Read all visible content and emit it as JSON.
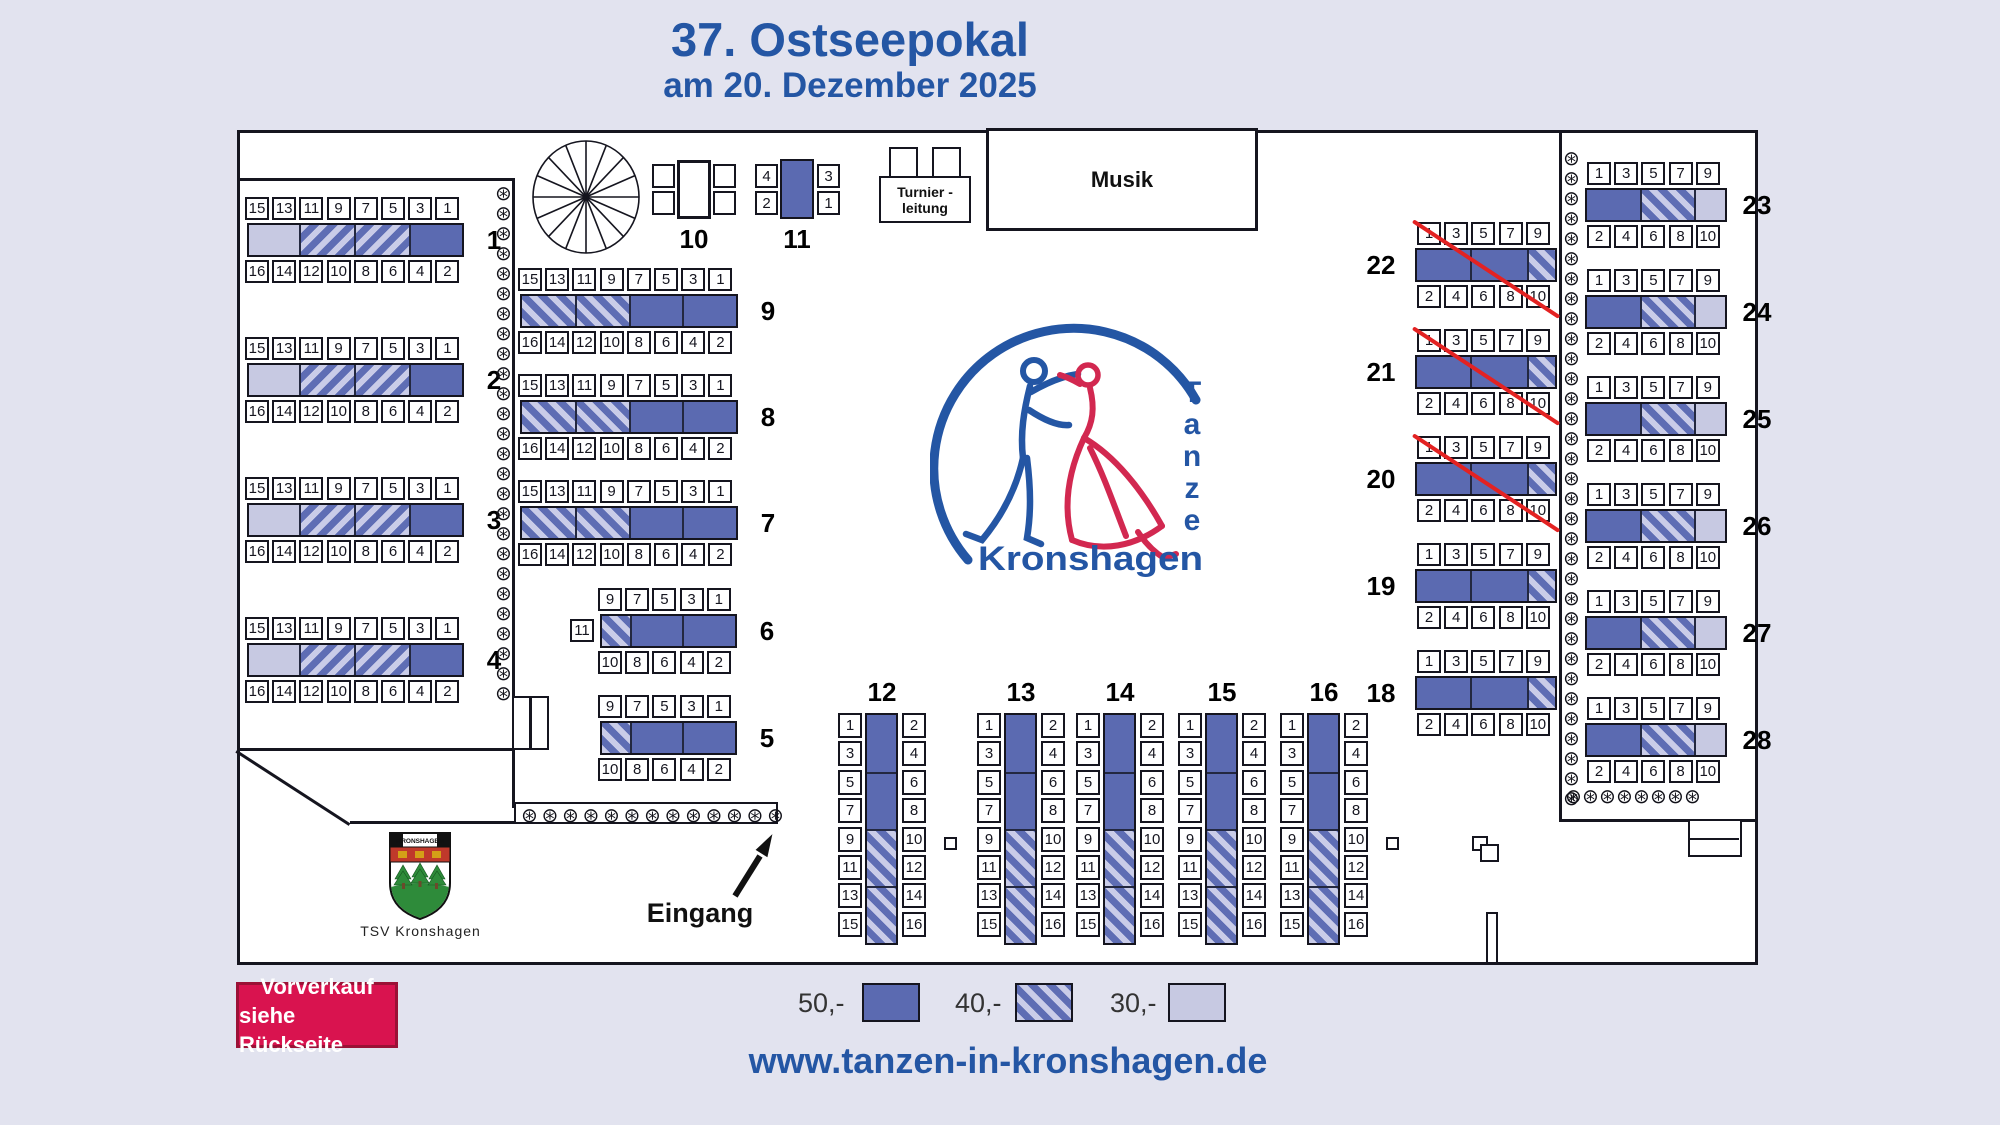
{
  "title": {
    "line1": "37. Ostseepokal",
    "line2": "am 20. Dezember 2025"
  },
  "footer": {
    "url": "www.tanzen-in-kronshagen.de"
  },
  "presale": {
    "line1": "Vorverkauf",
    "line2": "siehe Rückseite"
  },
  "legend": {
    "items": [
      {
        "price": "50,-",
        "cls": "p50"
      },
      {
        "price": "40,-",
        "cls": "h40b"
      },
      {
        "price": "30,-",
        "cls": "p30"
      }
    ]
  },
  "areas": {
    "musik": "Musik",
    "turnier_line1": "Turnier -",
    "turnier_line2": "leitung",
    "eingang": "Eingang",
    "tsv_caption": "TSV Kronshagen"
  },
  "logo": {
    "v": [
      "T",
      "a",
      "n",
      "z",
      "e"
    ],
    "bottom": "Kronshagen",
    "crest_title": "KRONSHAGEN"
  },
  "colors": {
    "accent_blue": "#2456a4",
    "price50": "#5b6ab1",
    "price40_stripe": "#5e6db4",
    "price40_bg": "#c9cce8",
    "price30": "#c7c9e2",
    "badge": "#d9134f",
    "cross_red": "#e32222",
    "page_bg": "#e2e3ef"
  },
  "flower_glyph": "⊛",
  "flower_runs": [
    {
      "name": "plant-column-left",
      "x": 495,
      "y": 183,
      "dx": 0,
      "dy": 20,
      "n": 26
    },
    {
      "name": "plant-column-right",
      "x": 1563,
      "y": 148,
      "dx": 0,
      "dy": 20,
      "n": 33
    },
    {
      "name": "plant-row-bottom-right",
      "x": 1565,
      "y": 786,
      "dx": 17,
      "dy": 0,
      "n": 8
    },
    {
      "name": "plant-box-row",
      "x": 521,
      "y": 805,
      "dx": 20.5,
      "dy": 0,
      "n": 13
    }
  ],
  "seat_sets": {
    "w8_top": [
      "15",
      "13",
      "11",
      "9",
      "7",
      "5",
      "3",
      "1"
    ],
    "w8_bot": [
      "16",
      "14",
      "12",
      "10",
      "8",
      "6",
      "4",
      "2"
    ],
    "w5_top": [
      "9",
      "7",
      "5",
      "3",
      "1"
    ],
    "w5_bot": [
      "10",
      "8",
      "6",
      "4",
      "2"
    ],
    "e5_top": [
      "1",
      "3",
      "5",
      "7",
      "9"
    ],
    "e5_bot": [
      "2",
      "4",
      "6",
      "8",
      "10"
    ],
    "v_left": [
      "1",
      "3",
      "5",
      "7",
      "9",
      "11",
      "13",
      "15"
    ],
    "v_right": [
      "2",
      "4",
      "6",
      "8",
      "10",
      "12",
      "14",
      "16"
    ]
  },
  "tables": [
    {
      "n": "1",
      "o": "h",
      "x": 245,
      "y": 197,
      "set": "w8",
      "segs": [
        [
          50,
          "p30"
        ],
        [
          55,
          "h40a"
        ],
        [
          55,
          "h40a"
        ],
        [
          53,
          "p50"
        ]
      ],
      "side": "right"
    },
    {
      "n": "2",
      "o": "h",
      "x": 245,
      "y": 337,
      "set": "w8",
      "segs": [
        [
          50,
          "p30"
        ],
        [
          55,
          "h40a"
        ],
        [
          55,
          "h40a"
        ],
        [
          53,
          "p50"
        ]
      ],
      "side": "right"
    },
    {
      "n": "3",
      "o": "h",
      "x": 245,
      "y": 477,
      "set": "w8",
      "segs": [
        [
          50,
          "p30"
        ],
        [
          55,
          "h40a"
        ],
        [
          55,
          "h40a"
        ],
        [
          53,
          "p50"
        ]
      ],
      "side": "right"
    },
    {
      "n": "4",
      "o": "h",
      "x": 245,
      "y": 617,
      "set": "w8",
      "segs": [
        [
          50,
          "p30"
        ],
        [
          55,
          "h40a"
        ],
        [
          55,
          "h40a"
        ],
        [
          53,
          "p50"
        ]
      ],
      "side": "right"
    },
    {
      "n": "9",
      "o": "h",
      "x": 518,
      "y": 268,
      "set": "w8",
      "segs": [
        [
          53,
          "h40b"
        ],
        [
          54,
          "h40b"
        ],
        [
          53,
          "p50"
        ],
        [
          54,
          "p50"
        ]
      ],
      "side": "right"
    },
    {
      "n": "8",
      "o": "h",
      "x": 518,
      "y": 374,
      "set": "w8",
      "segs": [
        [
          53,
          "h40b"
        ],
        [
          54,
          "h40b"
        ],
        [
          53,
          "p50"
        ],
        [
          54,
          "p50"
        ]
      ],
      "side": "right"
    },
    {
      "n": "7",
      "o": "h",
      "x": 518,
      "y": 480,
      "set": "w8",
      "segs": [
        [
          53,
          "h40b"
        ],
        [
          54,
          "h40b"
        ],
        [
          53,
          "p50"
        ],
        [
          54,
          "p50"
        ]
      ],
      "side": "right"
    },
    {
      "n": "6",
      "o": "h",
      "x": 598,
      "y": 588,
      "set": "w5",
      "segs": [
        [
          28,
          "h40b"
        ],
        [
          52,
          "p50"
        ],
        [
          53,
          "p50"
        ]
      ],
      "side": "right",
      "extra": {
        "n": "11",
        "x": 570,
        "y": 619
      }
    },
    {
      "n": "5",
      "o": "h",
      "x": 598,
      "y": 695,
      "set": "w5",
      "segs": [
        [
          28,
          "h40b"
        ],
        [
          52,
          "p50"
        ],
        [
          53,
          "p50"
        ]
      ],
      "side": "right"
    },
    {
      "n": "12",
      "o": "v",
      "x": 838,
      "y": 713,
      "set": "v",
      "segs": [
        [
          57,
          "p50"
        ],
        [
          57,
          "p50"
        ],
        [
          57,
          "h40b"
        ],
        [
          57,
          "h40b"
        ]
      ],
      "side": "top"
    },
    {
      "n": "13",
      "o": "v",
      "x": 977,
      "y": 713,
      "set": "v",
      "segs": [
        [
          57,
          "p50"
        ],
        [
          57,
          "p50"
        ],
        [
          57,
          "h40b"
        ],
        [
          57,
          "h40b"
        ]
      ],
      "side": "top"
    },
    {
      "n": "14",
      "o": "v",
      "x": 1076,
      "y": 713,
      "set": "v",
      "segs": [
        [
          57,
          "p50"
        ],
        [
          57,
          "p50"
        ],
        [
          57,
          "h40b"
        ],
        [
          57,
          "h40b"
        ]
      ],
      "side": "top"
    },
    {
      "n": "15",
      "o": "v",
      "x": 1178,
      "y": 713,
      "set": "v",
      "segs": [
        [
          57,
          "p50"
        ],
        [
          57,
          "p50"
        ],
        [
          57,
          "h40b"
        ],
        [
          57,
          "h40b"
        ]
      ],
      "side": "top"
    },
    {
      "n": "16",
      "o": "v",
      "x": 1280,
      "y": 713,
      "set": "v",
      "segs": [
        [
          57,
          "p50"
        ],
        [
          57,
          "p50"
        ],
        [
          57,
          "h40b"
        ],
        [
          57,
          "h40b"
        ]
      ],
      "side": "top"
    },
    {
      "n": "22",
      "o": "h",
      "x": 1417,
      "y": 222,
      "set": "e5",
      "segs": [
        [
          53,
          "p50"
        ],
        [
          57,
          "p50"
        ],
        [
          28,
          "h40b"
        ]
      ],
      "side": "left",
      "bdx": -2,
      "crossed": true
    },
    {
      "n": "21",
      "o": "h",
      "x": 1417,
      "y": 329,
      "set": "e5",
      "segs": [
        [
          53,
          "p50"
        ],
        [
          57,
          "p50"
        ],
        [
          28,
          "h40b"
        ]
      ],
      "side": "left",
      "bdx": -2,
      "crossed": true
    },
    {
      "n": "20",
      "o": "h",
      "x": 1417,
      "y": 436,
      "set": "e5",
      "segs": [
        [
          53,
          "p50"
        ],
        [
          57,
          "p50"
        ],
        [
          28,
          "h40b"
        ]
      ],
      "side": "left",
      "bdx": -2,
      "crossed": true
    },
    {
      "n": "19",
      "o": "h",
      "x": 1417,
      "y": 543,
      "set": "e5",
      "segs": [
        [
          53,
          "p50"
        ],
        [
          57,
          "p50"
        ],
        [
          28,
          "h40b"
        ]
      ],
      "side": "left",
      "bdx": -2
    },
    {
      "n": "18",
      "o": "h",
      "x": 1417,
      "y": 650,
      "set": "e5",
      "segs": [
        [
          53,
          "p50"
        ],
        [
          57,
          "p50"
        ],
        [
          28,
          "h40b"
        ]
      ],
      "side": "left",
      "bdx": -2
    },
    {
      "n": "23",
      "o": "h",
      "x": 1587,
      "y": 162,
      "set": "e5",
      "segs": [
        [
          53,
          "p50"
        ],
        [
          54,
          "h40b"
        ],
        [
          31,
          "p30"
        ]
      ],
      "side": "right",
      "bdx": -2
    },
    {
      "n": "24",
      "o": "h",
      "x": 1587,
      "y": 269,
      "set": "e5",
      "segs": [
        [
          53,
          "p50"
        ],
        [
          54,
          "h40b"
        ],
        [
          31,
          "p30"
        ]
      ],
      "side": "right",
      "bdx": -2
    },
    {
      "n": "25",
      "o": "h",
      "x": 1587,
      "y": 376,
      "set": "e5",
      "segs": [
        [
          53,
          "p50"
        ],
        [
          54,
          "h40b"
        ],
        [
          31,
          "p30"
        ]
      ],
      "side": "right",
      "bdx": -2
    },
    {
      "n": "26",
      "o": "h",
      "x": 1587,
      "y": 483,
      "set": "e5",
      "segs": [
        [
          53,
          "p50"
        ],
        [
          54,
          "h40b"
        ],
        [
          31,
          "p30"
        ]
      ],
      "side": "right",
      "bdx": -2
    },
    {
      "n": "27",
      "o": "h",
      "x": 1587,
      "y": 590,
      "set": "e5",
      "segs": [
        [
          53,
          "p50"
        ],
        [
          54,
          "h40b"
        ],
        [
          31,
          "p30"
        ]
      ],
      "side": "right",
      "bdx": -2
    },
    {
      "n": "28",
      "o": "h",
      "x": 1587,
      "y": 697,
      "set": "e5",
      "segs": [
        [
          53,
          "p50"
        ],
        [
          54,
          "h40b"
        ],
        [
          31,
          "p30"
        ]
      ],
      "side": "right",
      "bdx": -2
    }
  ],
  "table10": {
    "label": "10"
  },
  "table11": {
    "label": "11",
    "seats": [
      "4",
      "2",
      "3",
      "1"
    ]
  }
}
